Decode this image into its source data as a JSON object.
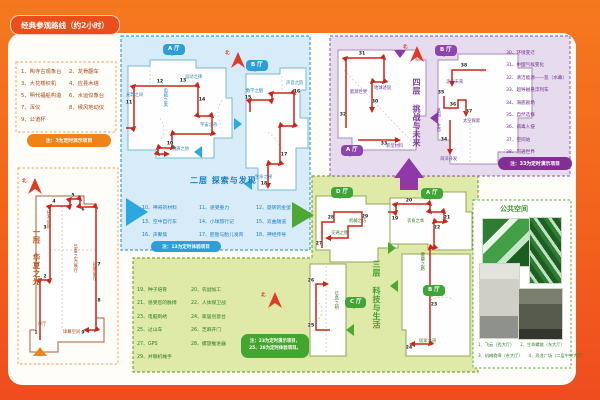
{
  "page_title": "经典参观路线（约2小时）",
  "north": "北",
  "colors": {
    "background_orange": "#F2611C",
    "floor1_accent": "#EF8318",
    "floor2_accent": "#2E9FD6",
    "floor3_accent": "#3FA535",
    "floor4_accent": "#8E44AD",
    "route_red": "#CE2418"
  },
  "floor1": {
    "title": "一层 华夏之光",
    "exhibits": [
      "1、陶寺古观象台",
      "2、龙骨翻车",
      "3、大花楼织机",
      "4、应县木塔",
      "5、明代福船构造",
      "6、水运仪象台",
      "7、浑仪",
      "8、候风地动仪",
      "9、公道杯"
    ],
    "note": "注：3为定时演示项目",
    "stops": [
      "1",
      "2",
      "3",
      "4",
      "5",
      "6",
      "7",
      "8",
      "9"
    ],
    "map_labels": {
      "xuting": "序厅",
      "qiumu": "球幕空间",
      "jishu": "技术创新",
      "zhanting": "华夏之光展厅",
      "duanqi": "短期展厅"
    }
  },
  "floor2": {
    "title": "二层 探索与发现",
    "halls": [
      "A 厅",
      "B 厅"
    ],
    "areas": [
      "光影之间",
      "电磁之奥",
      "运动之律",
      "宇宙之奇",
      "物质之妙",
      "数学之魅",
      "声音之韵",
      "生命之秘"
    ],
    "exhibits": [
      "10、神奇的材料",
      "11、感受重力",
      "12、旋转的金蛋",
      "13、空中自行车",
      "14、小球旅行记",
      "15、双曲隧道",
      "16、声聚焦",
      "17、胚胎与胎儿发育",
      "18、神经传导"
    ],
    "note": "注：13为定时体验项目",
    "stops": [
      "10",
      "11",
      "12",
      "13",
      "14",
      "15",
      "16",
      "17",
      "18"
    ]
  },
  "floor3": {
    "title": "三层 科技与生活",
    "halls": [
      "A 厅",
      "B 厅",
      "C 厅",
      "D 厅"
    ],
    "areas": [
      "衣食之本",
      "健康之路",
      "居家之道",
      "信息之桥",
      "交通之便",
      "机械之巧"
    ],
    "exhibits": [
      "19、种子培育",
      "20、农副加工",
      "21、感受您的脉搏",
      "22、人体保卫战",
      "23、电脑刺绣",
      "24、家居创意台",
      "25、过山车",
      "26、芝麻开门",
      "27、GPS",
      "28、螺旋推进器",
      "29、并联机械手"
    ],
    "note_line1": "注：23为定时演示项目，",
    "note_line2": "25、28为定时体验项目。",
    "stops": [
      "19",
      "20",
      "21",
      "22",
      "23",
      "24",
      "25",
      "26",
      "27",
      "28",
      "29"
    ]
  },
  "floor4": {
    "title": "四层 挑战与未来",
    "halls": [
      "A 厅",
      "B 厅"
    ],
    "areas": [
      "能源世界",
      "地球述说",
      "新型材料",
      "走向未来",
      "基因·生命",
      "太空探索",
      "海洋开发"
    ],
    "exhibits": [
      "30、环境变迁",
      "31、中国气候变化",
      "32、清洁能源——氢（水幕）",
      "33、超导磁悬浮列车",
      "34、海底剧场",
      "35、自然选择",
      "36、病毒入侵",
      "37、空间站",
      "38、沟通世界"
    ],
    "note": "注：33为定时演示项目",
    "stops": [
      "30",
      "31",
      "32",
      "33",
      "34",
      "35",
      "36",
      "37",
      "38"
    ]
  },
  "public_space": {
    "title": "公共空间",
    "captions": [
      "1、飞云（西大厅）",
      "2、生命螺旋（东大厅）",
      "3、机械旋律（东大厅）",
      "4、恐龙广场（二层中央大厅）"
    ]
  }
}
